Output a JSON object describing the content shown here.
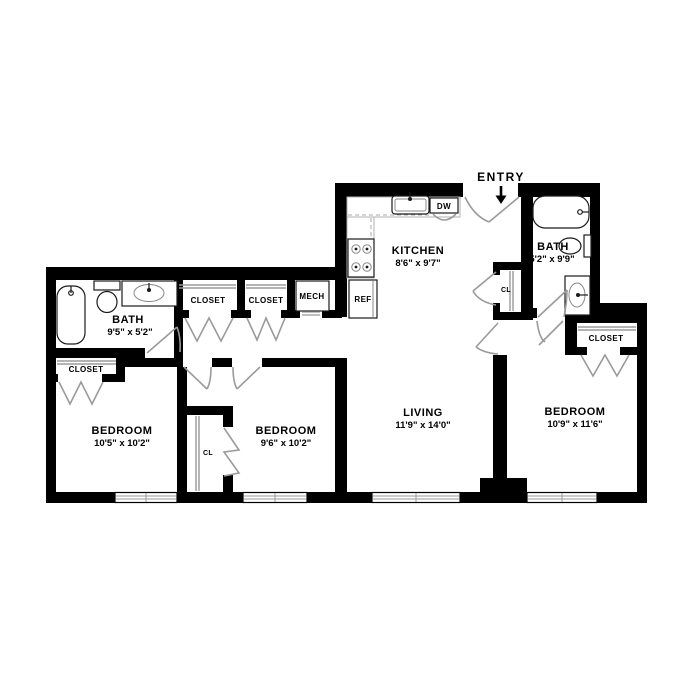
{
  "plan": {
    "entry": {
      "label": "ENTRY"
    },
    "rooms": {
      "kitchen": {
        "name": "KITCHEN",
        "dims": "8'6\" x 9'7\""
      },
      "living": {
        "name": "LIVING",
        "dims": "11'9\" x 14'0\""
      },
      "bath_left": {
        "name": "BATH",
        "dims": "9'5\" x 5'2\""
      },
      "bath_right": {
        "name": "BATH",
        "dims": "5'2\" x 9'9\""
      },
      "bedroom_left": {
        "name": "BEDROOM",
        "dims": "10'5\" x 10'2\""
      },
      "bedroom_middle": {
        "name": "BEDROOM",
        "dims": "9'6\" x 10'2\""
      },
      "bedroom_right": {
        "name": "BEDROOM",
        "dims": "10'9\" x 11'6\""
      }
    },
    "labels": {
      "closet_hall_1": "CLOSET",
      "closet_hall_2": "CLOSET",
      "closet_left": "CLOSET",
      "closet_bedroom_right": "CLOSET",
      "cl_entry": "CL",
      "cl_bedroom": "CL",
      "mech": "MECH",
      "ref": "REF",
      "dw": "DW"
    },
    "colors": {
      "wall": "#000000",
      "door_swing": "#9a9a9a",
      "background": "#ffffff"
    }
  }
}
